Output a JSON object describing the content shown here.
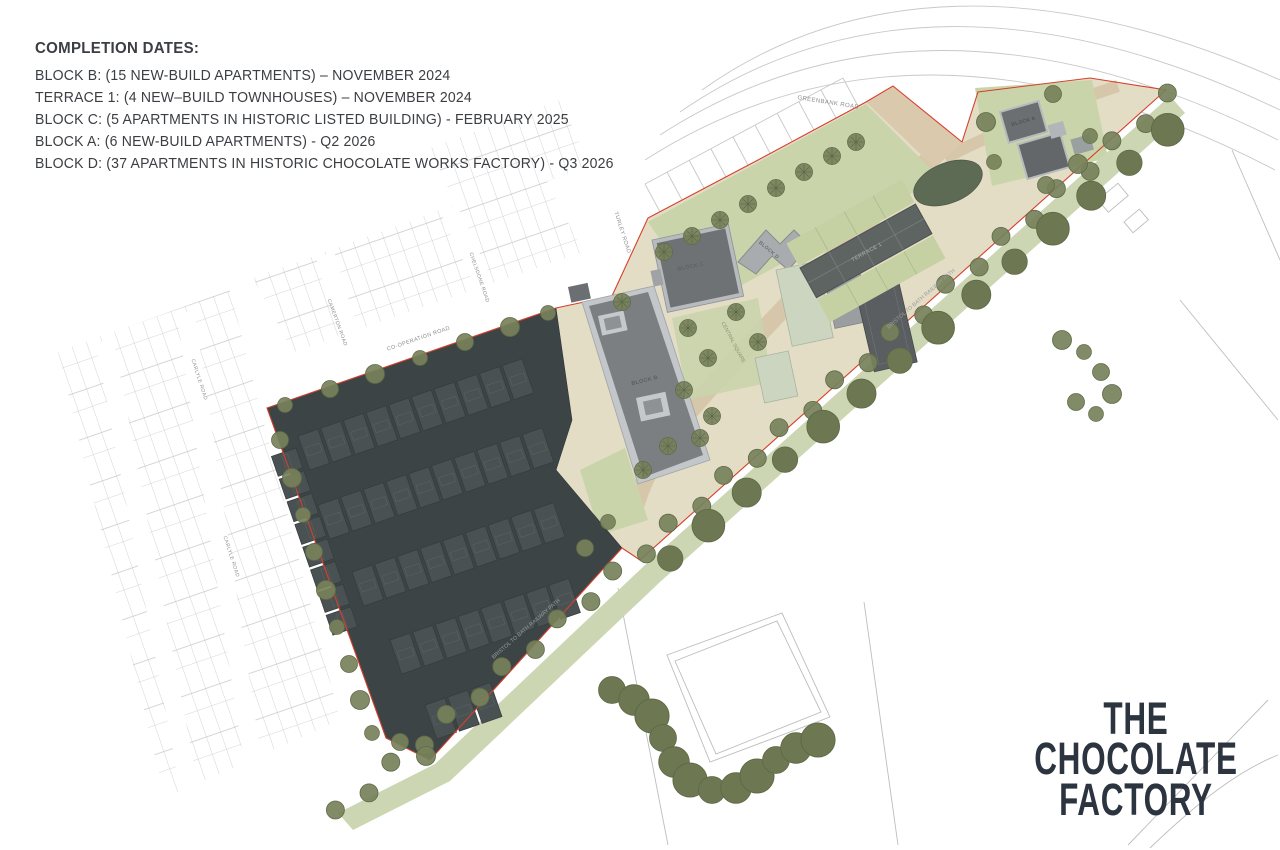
{
  "annotation": {
    "title": "COMPLETION DATES:",
    "lines": [
      "BLOCK B: (15 NEW-BUILD APARTMENTS) – NOVEMBER 2024",
      "TERRACE 1: (4 NEW–BUILD TOWNHOUSES) – NOVEMBER 2024",
      "BLOCK C: (5 APARTMENTS IN HISTORIC LISTED BUILDING) - FEBRUARY 2025",
      "BLOCK A: (6 NEW-BUILD APARTMENTS) - Q2 2026",
      "BLOCK D: (37 APARTMENTS IN HISTORIC CHOCOLATE WORKS FACTORY) - Q3 2026"
    ]
  },
  "logo": {
    "lines": [
      "THE",
      "CHOCOLATE",
      "FACTORY"
    ]
  },
  "map": {
    "roads": {
      "greenbank": "GREENBANK ROAD",
      "turley": "TURLEY ROAD",
      "chelsdone": "CHELSDONE ROAD",
      "camerton": "CAMERTON ROAD",
      "carlyle": "CARLYLE ROAD",
      "cooperation": "CO-OPERATION ROAD",
      "railway_path": "BRISTOL TO BATH RAILWAY PATH"
    },
    "places": {
      "central_square": "CENTRAL SQUARE"
    },
    "buildings": {
      "block_a": "BLOCK A",
      "block_b": "BLOCK B",
      "block_c": "BLOCK C",
      "block_d": "BLOCK D",
      "terrace_1": "TERRACE 1"
    }
  },
  "colors": {
    "boundary_red": "#d6402b",
    "tree_green": "#76815a",
    "tree_stroke": "#5f6a49",
    "hedge_green": "#6d7852",
    "lawn_green": "#c9d4ab",
    "site_beige": "#e4ddc6",
    "road_tan": "#d7c7aa",
    "dark_area": "#3d4446",
    "house_dark": "#4a5152",
    "building_gray": "#7b7f82",
    "logo_navy": "#2c3440",
    "text_dark": "#3b3e42"
  }
}
